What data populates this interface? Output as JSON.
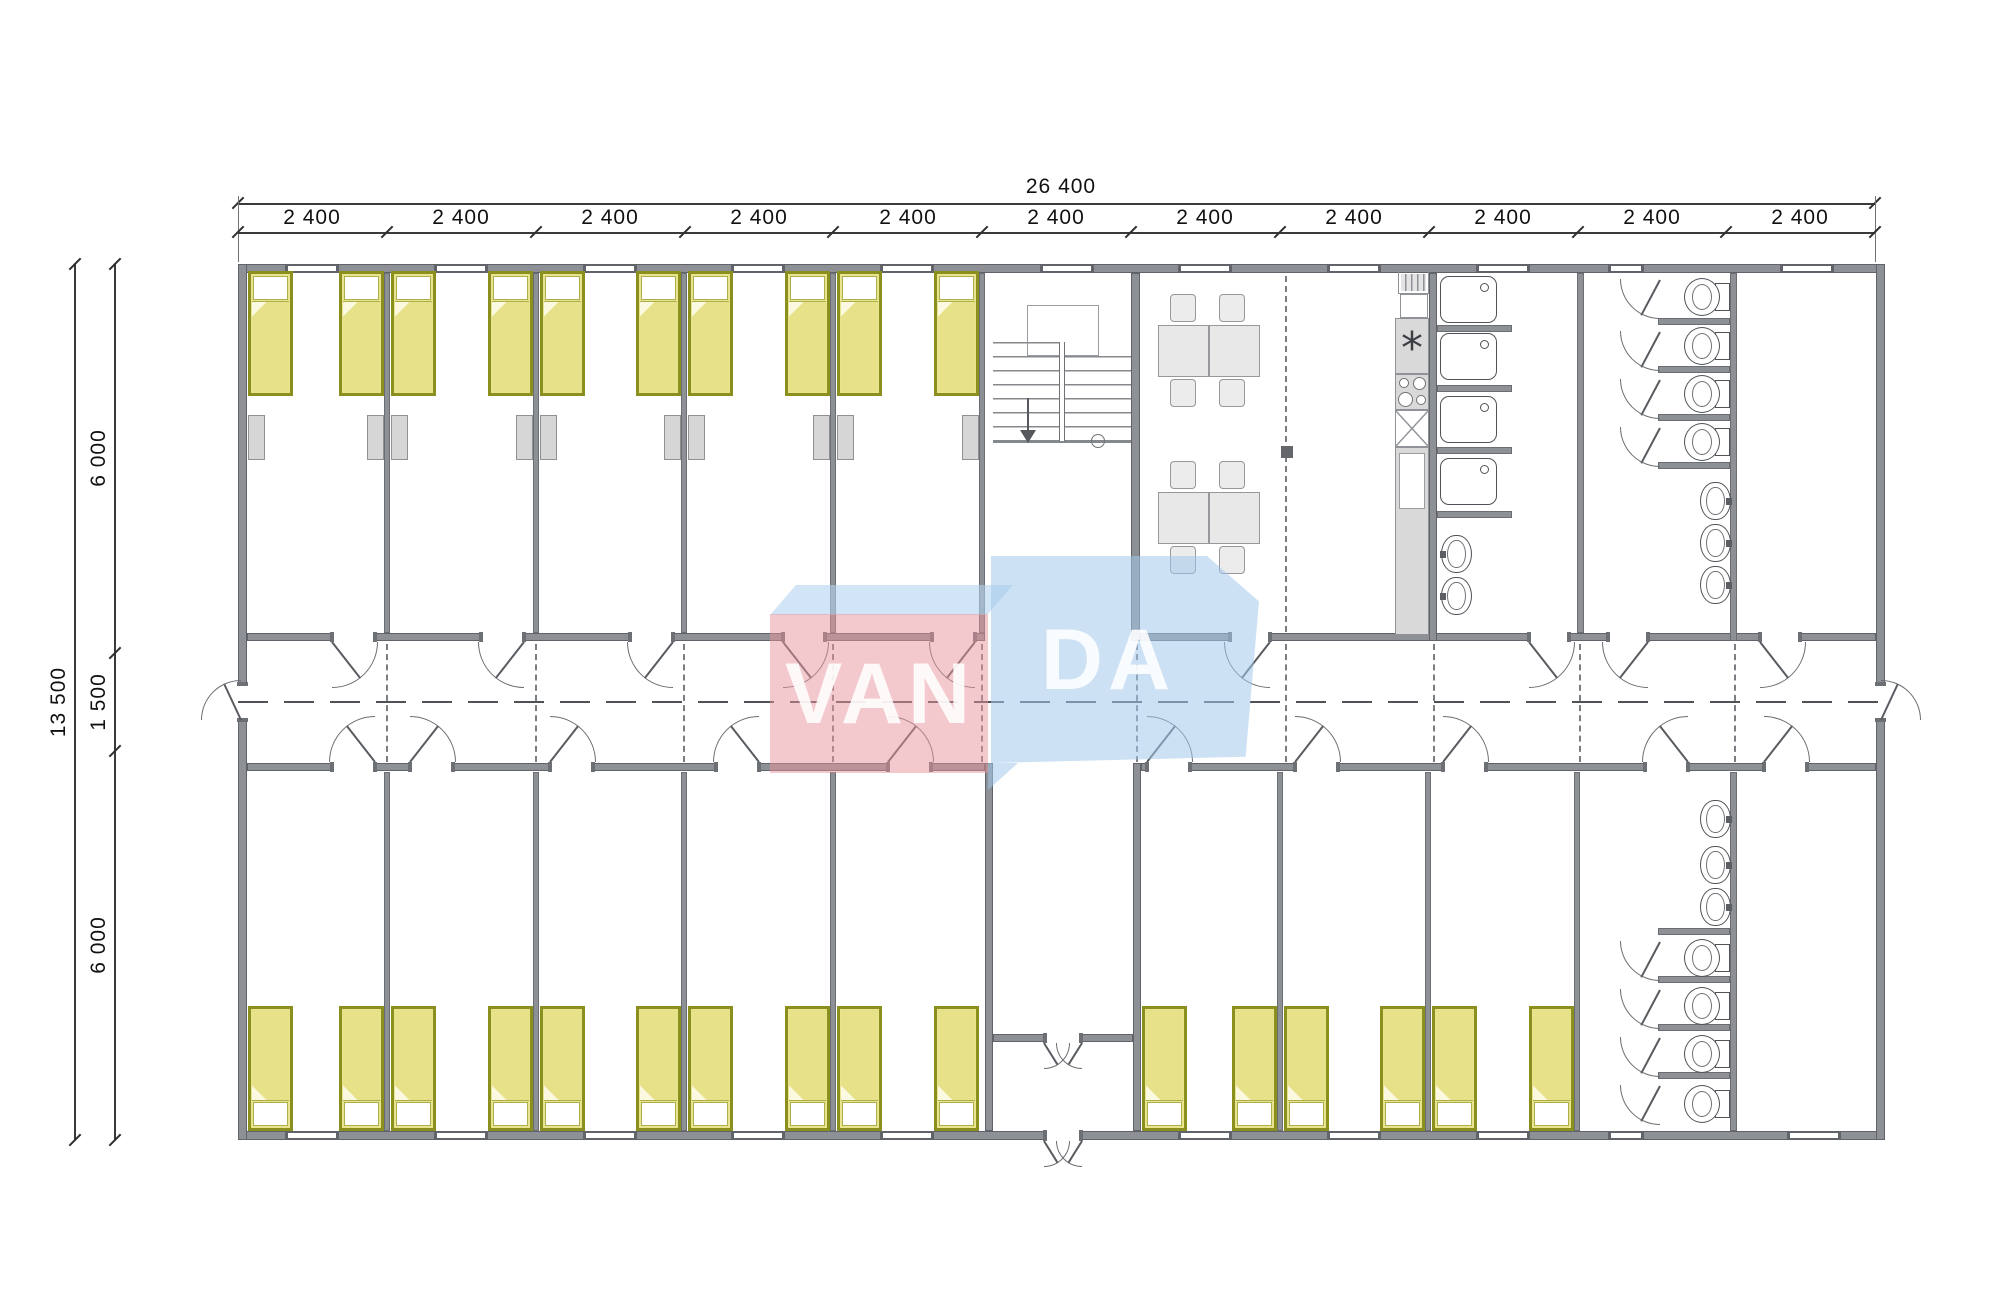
{
  "logo": {
    "text_left": "VAN",
    "text_right": "DA"
  },
  "dimensions": {
    "overall_width": "26 400",
    "module_widths": [
      "2 400",
      "2 400",
      "2 400",
      "2 400",
      "2 400",
      "2 400",
      "2 400",
      "2 400",
      "2 400",
      "2 400",
      "2 400"
    ],
    "overall_height": "13 500",
    "height_segments": [
      "6 000",
      "1 500",
      "6 000"
    ]
  }
}
